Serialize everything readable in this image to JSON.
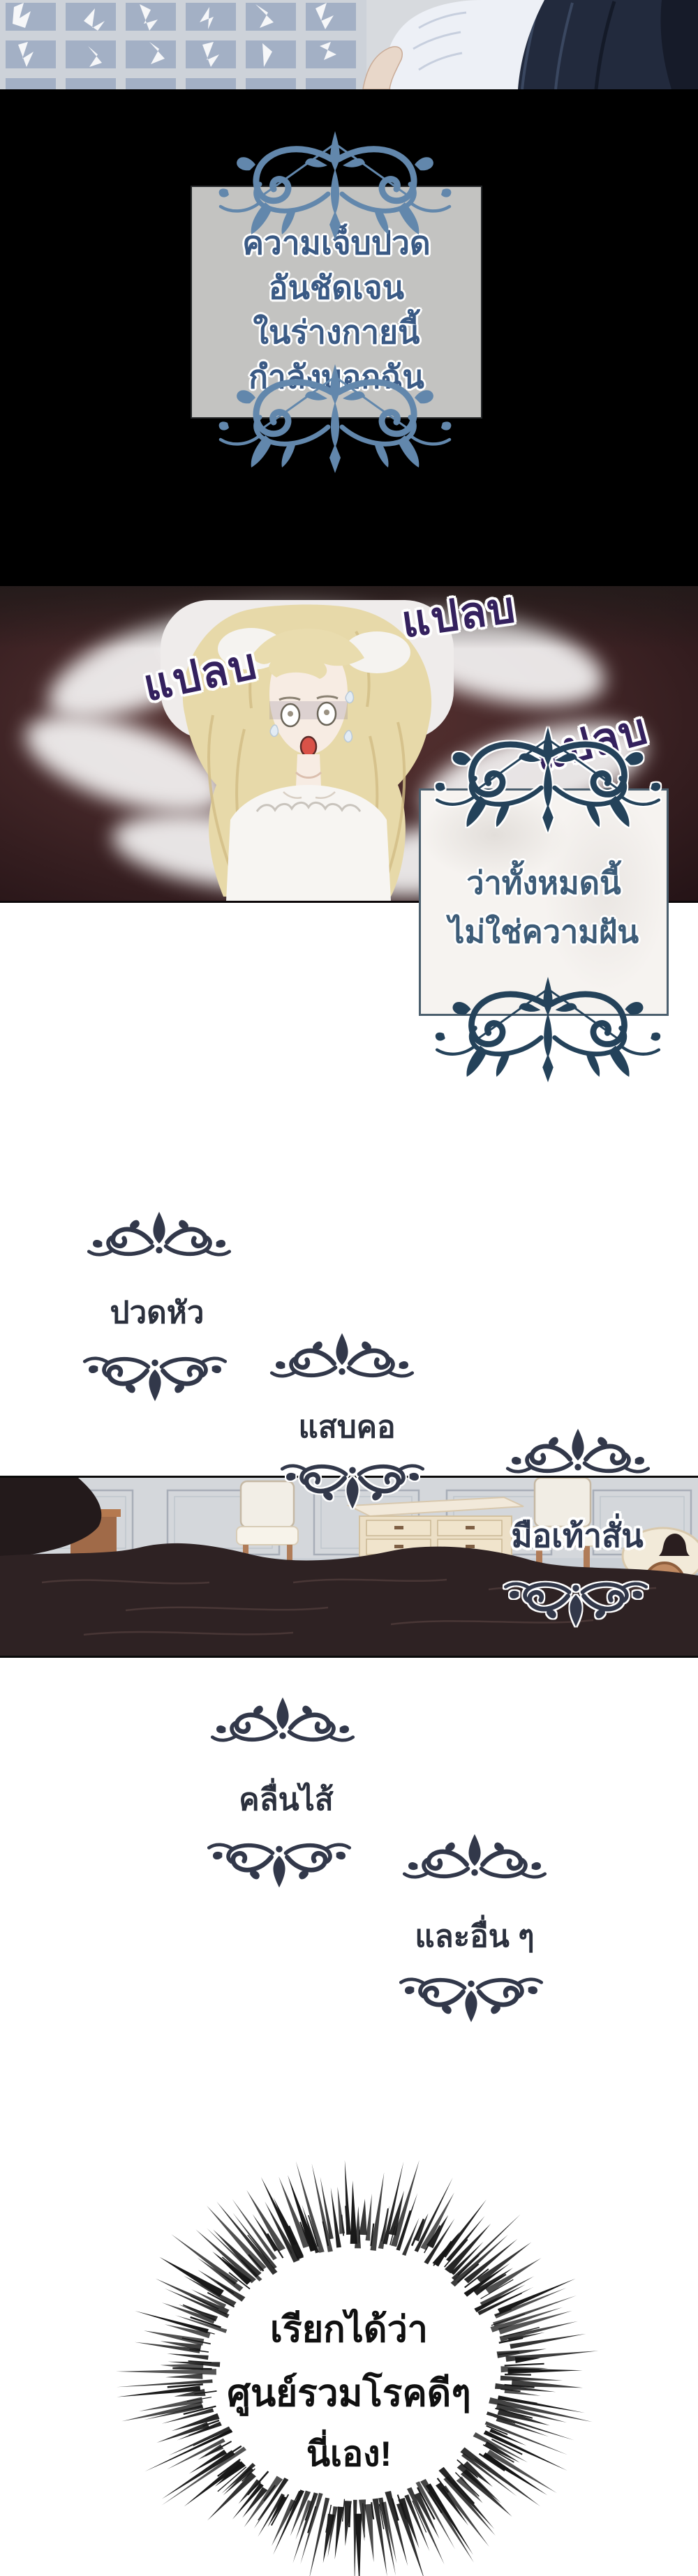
{
  "narration_box_1": {
    "lines": [
      "ความเจ็บปวด",
      "อันชัดเจน",
      "ในร่างกายนี้",
      "กำลังบอกฉัน"
    ]
  },
  "sfx": {
    "label": "แปลบ",
    "instances": 3
  },
  "narration_box_2": {
    "lines": [
      "ว่าทั้งหมดนี้",
      "ไม่ใช่ความฝัน"
    ]
  },
  "symptoms": {
    "headache": "ปวดหัว",
    "sore_throat": "แสบคอ",
    "trembling_hands_feet": "มือเท้าสั่น",
    "nausea": "คลื่นไส้",
    "and_others": "และอื่น ๆ"
  },
  "burst": {
    "lines": [
      "เรียกได้ว่า",
      "ศูนย์รวมโรคดีๆ",
      "นี่เอง!"
    ]
  },
  "colors": {
    "sfx_text": "#34215e",
    "narration1_text": "#3a5a85",
    "narration1_box": "#c3c3c1",
    "narration2_text": "#3d5c78",
    "symptom_text": "#2b303d",
    "ornament_blue": "#6287ac",
    "ornament_navy": "#24425a",
    "ornament_dark": "#32384a",
    "panel_red_bg": "#47292a",
    "blanket_dark": "#2e2223",
    "burst_text": "#101010"
  }
}
